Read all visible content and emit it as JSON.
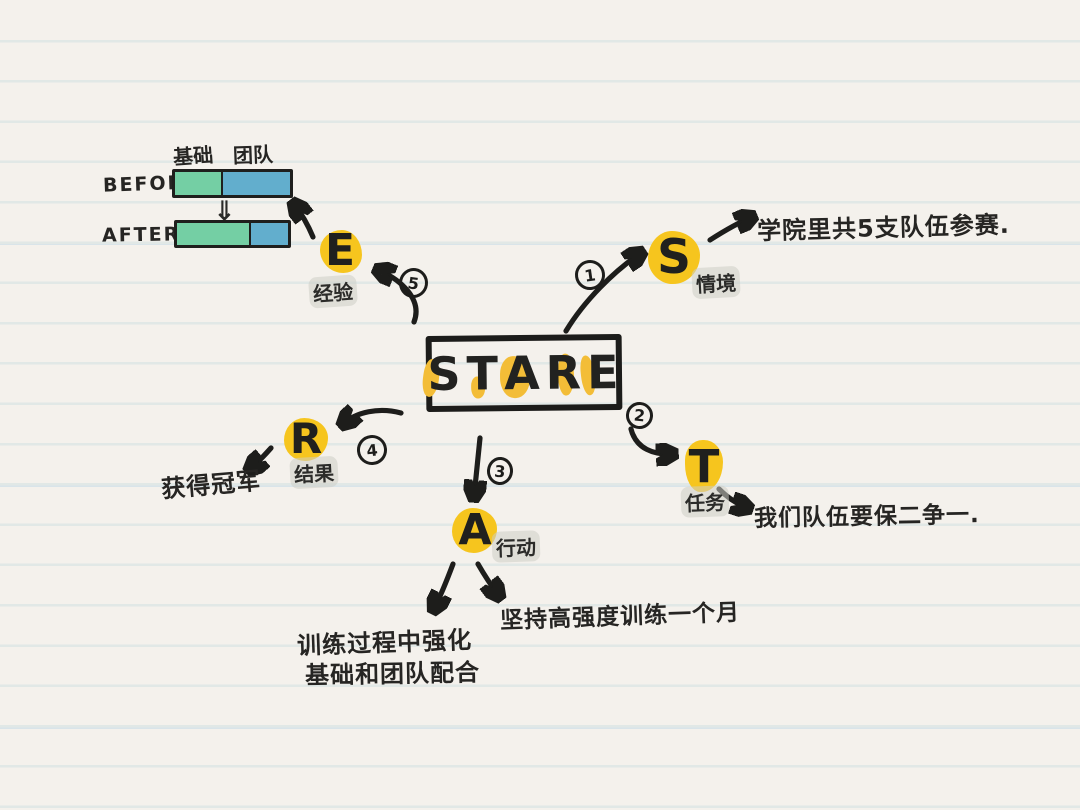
{
  "colors": {
    "paper": "#f4f1ec",
    "rule_line": "#e1e8e6",
    "ink": "#1d1d1b",
    "accent_yellow": "#f6c51e",
    "bar_green": "#74cfa4",
    "bar_blue": "#62aecd",
    "label_highlight": "#cdcdc6"
  },
  "center": {
    "title": "STARE",
    "letters": [
      "S",
      "T",
      "A",
      "R",
      "E"
    ]
  },
  "nodes": {
    "s": {
      "letter": "S",
      "label": "情境",
      "number": "1",
      "note": "学院里共5支队伍参赛."
    },
    "t": {
      "letter": "T",
      "label": "任务",
      "number": "2",
      "note": "我们队伍要保二争一."
    },
    "a": {
      "letter": "A",
      "label": "行动",
      "number": "3",
      "note_right": "坚持高强度训练一个月",
      "note_left_line1": "训练过程中强化",
      "note_left_line2": "基础和团队配合"
    },
    "r": {
      "letter": "R",
      "label": "结果",
      "number": "4",
      "note": "获得冠军"
    },
    "e": {
      "letter": "E",
      "label": "经验",
      "number": "5"
    }
  },
  "chart_data": {
    "type": "bar",
    "title": "",
    "categories": [
      "基础",
      "团队"
    ],
    "rows": [
      {
        "label": "BEFORE",
        "values": {
          "基础": 42,
          "团队": 58
        }
      },
      {
        "label": "AFTER",
        "values": {
          "基础": 67,
          "团队": 33
        }
      }
    ],
    "value_unit": "percent of bar width",
    "transition_glyph": "⇓",
    "legend_position": "top",
    "grid": false
  }
}
